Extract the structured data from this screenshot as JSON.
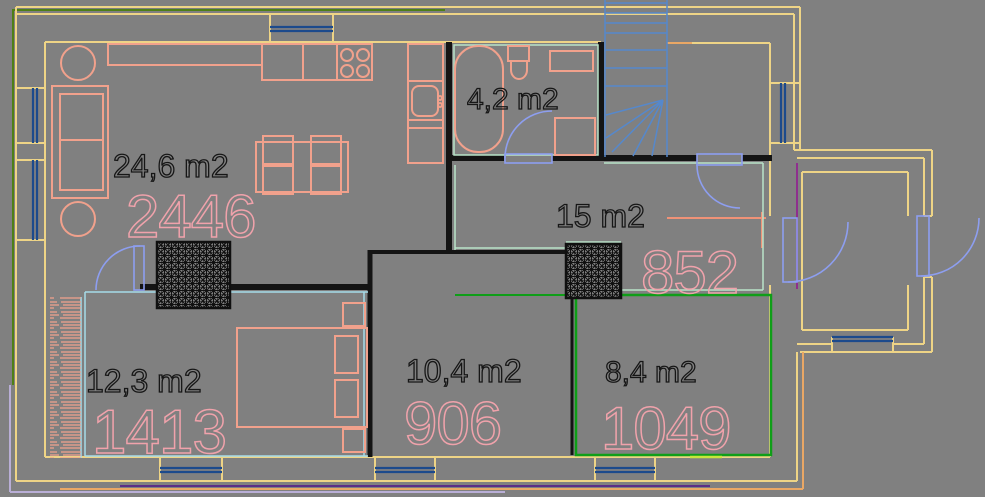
{
  "app": {
    "type": "cad-floor-plan",
    "background": "#808080"
  },
  "rooms": [
    {
      "id": "living-room",
      "area_label": "24,6 m2",
      "code": "2446"
    },
    {
      "id": "bathroom",
      "area_label": "4,2 m2",
      "code": ""
    },
    {
      "id": "hall",
      "area_label": "15 m2",
      "code": "852"
    },
    {
      "id": "bedroom",
      "area_label": "12,3 m2",
      "code": "1413"
    },
    {
      "id": "room-center",
      "area_label": "10,4 m2",
      "code": "906"
    },
    {
      "id": "room-right",
      "area_label": "8,4 m2",
      "code": "1049"
    }
  ],
  "colors": {
    "background": "#808080",
    "wall_yellow": "#eed486",
    "wall_black": "#141414",
    "outer_green": "#4e7f15",
    "room_green": "#0f9e18",
    "chartreuse": "#c8e63c",
    "mint": "#b9e4c9",
    "cyan": "#a6dce9",
    "stairs_blue": "#5588cc",
    "door_blue": "#8d9ef0",
    "window_navy": "#1c4a8c",
    "furniture_salmon": "#f1a18c",
    "label_black": "#161616",
    "code_pink": "#f0a2ab",
    "orange": "#e9a765",
    "purple": "#5b2d86",
    "lavender": "#b9aed6",
    "magenta": "#8e2f8e",
    "salmon_line": "#ef9277"
  }
}
